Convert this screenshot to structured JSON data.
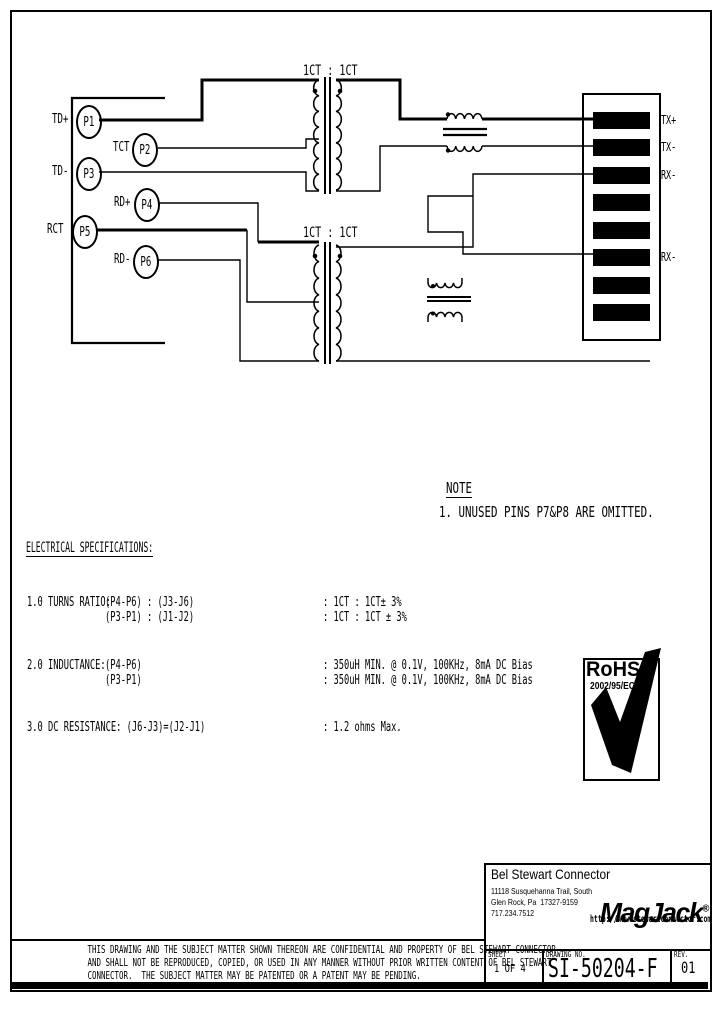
{
  "schematic": {
    "transformer_top_label": "1CT : 1CT",
    "transformer_bottom_label": "1CT : 1CT",
    "left_pins": [
      {
        "signal": "TD+",
        "pin": "P1"
      },
      {
        "signal": "TCT",
        "pin": "P2"
      },
      {
        "signal": "TD-",
        "pin": "P3"
      },
      {
        "signal": "RD+",
        "pin": "P4"
      },
      {
        "signal": "RCT",
        "pin": "P5"
      },
      {
        "signal": "RD-",
        "pin": "P6"
      }
    ],
    "right_pins": [
      {
        "pin": "J1",
        "signal": "TX+"
      },
      {
        "pin": "J2",
        "signal": "TX-"
      },
      {
        "pin": "J3",
        "signal": "RX-"
      },
      {
        "pin": "J4",
        "signal": ""
      },
      {
        "pin": "J5",
        "signal": ""
      },
      {
        "pin": "J6",
        "signal": "RX-"
      },
      {
        "pin": "J7",
        "signal": ""
      },
      {
        "pin": "J8",
        "signal": ""
      }
    ]
  },
  "note": {
    "heading": "NOTE",
    "item1": "1. UNUSED PINS P7&P8 ARE OMITTED."
  },
  "specs": {
    "heading": "ELECTRICAL SPECIFICATIONS:",
    "r1a": "1.0 TURNS RATIO:",
    "r1b": "(P4-P6) : (J3-J6)",
    "r1c": ": 1CT : 1CT± 3%",
    "r2b": "(P3-P1) : (J1-J2)",
    "r2c": ": 1CT : 1CT ± 3%",
    "r3a": "2.0 INDUCTANCE:",
    "r3b": "(P4-P6)",
    "r3c": ": 350uH MIN. @ 0.1V, 100KHz, 8mA DC Bias",
    "r4b": "(P3-P1)",
    "r4c": ": 350uH MIN. @ 0.1V, 100KHz, 8mA DC Bias",
    "r5a": "3.0 DC RESISTANCE: (J6-J3)=(J2-J1)",
    "r5c": ": 1.2 ohms Max."
  },
  "rohs": {
    "title": "RoHS",
    "directive": "2002/95/EC"
  },
  "title_block": {
    "company": {
      "name": "Bel Stewart Connector",
      "addr1": "11118 Susquehanna Trail, South",
      "addr2": "Glen Rock, Pa  17327-9159",
      "phone": "717.234.7512"
    },
    "brand": {
      "logo": "MagJack",
      "reg": "®",
      "url": "http://www.stewartconnector.com"
    },
    "fields": {
      "sheet_label": "SHEET",
      "sheet_value": "1 OF 4",
      "drawing_label": "DRAWING NO.",
      "drawing_value": "SI-50204-F",
      "rev_label": "REV.",
      "rev_value": "01"
    }
  },
  "disclaimer": {
    "line1": "THIS DRAWING AND THE SUBJECT MATTER SHOWN THEREON ARE CONFIDENTIAL AND PROPERTY OF BEL STEWART CONNECTOR",
    "line2": "AND SHALL NOT BE REPRODUCED, COPIED, OR USED IN ANY MANNER WITHOUT PRIOR WRITTEN CONTENT OF BEL STEWART",
    "line3": "CONNECTOR.  THE SUBJECT MATTER MAY BE PATENTED OR A PATENT MAY BE PENDING."
  }
}
